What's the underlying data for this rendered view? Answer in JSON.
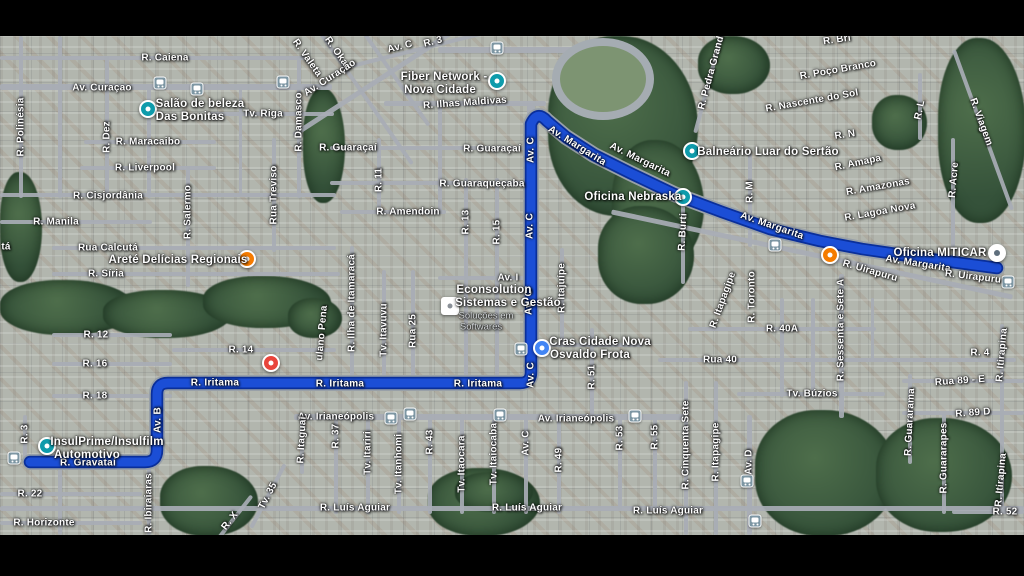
{
  "app": {
    "title": "Satellite map with driving route"
  },
  "colors": {
    "route": "#1b4ed6",
    "route_border": "#0a2f9a",
    "route_road_under": "#98a0a8",
    "label": "#ffffff",
    "sub_label": "#d8dbde",
    "poi_teal": "#0e9bab",
    "poi_orange": "#f57c00",
    "poi_red": "#e8453c",
    "poi_blue": "#4285f4",
    "poi_gray_inner": "#5f6f7d",
    "vegetation": "#3c5a40",
    "road": "#a8adb5",
    "letterbox": "#000000"
  },
  "route": {
    "path": "M 997 268 L 930 259 L 862 249 L 820 241 L 770 229 L 722 212 L 674 194 L 630 173 L 594 155 L 566 137 L 547 121 Q 537 110 531 124 L 531 372 Q 531 383 520 383 L 168 383 Q 157 383 157 394 L 157 450 Q 157 462 145 462 L 30 462"
  },
  "labels": [
    {
      "t": "R. Caiena",
      "x": 165,
      "y": 58,
      "r": 0,
      "c": "st"
    },
    {
      "t": "Av. Curaçao",
      "x": 102,
      "y": 88,
      "r": 0,
      "c": "st"
    },
    {
      "t": "Tv. Riga",
      "x": 263,
      "y": 114,
      "r": 0,
      "c": "st"
    },
    {
      "t": "R. Maracaibo",
      "x": 148,
      "y": 142,
      "r": 0,
      "c": "st"
    },
    {
      "t": "R. Liverpool",
      "x": 145,
      "y": 168,
      "r": 0,
      "c": "st"
    },
    {
      "t": "R. Cisjordânia",
      "x": 108,
      "y": 196,
      "r": 0,
      "c": "st"
    },
    {
      "t": "R. Manila",
      "x": 56,
      "y": 222,
      "r": 0,
      "c": "st"
    },
    {
      "t": "Rua Calcutá",
      "x": 108,
      "y": 248,
      "r": 0,
      "c": "st"
    },
    {
      "t": "tá",
      "x": 6,
      "y": 247,
      "r": 0,
      "c": "st"
    },
    {
      "t": "R. Síria",
      "x": 106,
      "y": 274,
      "r": 0,
      "c": "st"
    },
    {
      "t": "R. 12",
      "x": 96,
      "y": 335,
      "r": 0,
      "c": "st"
    },
    {
      "t": "R. 14",
      "x": 241,
      "y": 350,
      "r": 0,
      "c": "st"
    },
    {
      "t": "R. 16",
      "x": 95,
      "y": 364,
      "r": 0,
      "c": "st"
    },
    {
      "t": "R. 18",
      "x": 95,
      "y": 396,
      "r": 0,
      "c": "st"
    },
    {
      "t": "R. 22",
      "x": 30,
      "y": 494,
      "r": 0,
      "c": "st"
    },
    {
      "t": "R. Horizonte",
      "x": 44,
      "y": 523,
      "r": 0,
      "c": "st"
    },
    {
      "t": "R. Gravataí",
      "x": 88,
      "y": 463,
      "r": 0,
      "c": "rt"
    },
    {
      "t": "R. Iritama",
      "x": 215,
      "y": 383,
      "r": 0,
      "c": "rt"
    },
    {
      "t": "R. Iritama",
      "x": 340,
      "y": 384,
      "r": 0,
      "c": "rt"
    },
    {
      "t": "R. Iritama",
      "x": 478,
      "y": 384,
      "r": 0,
      "c": "rt"
    },
    {
      "t": "Av. B",
      "x": 158,
      "y": 420,
      "r": -90,
      "c": "rt"
    },
    {
      "t": "Av. C",
      "x": 531,
      "y": 150,
      "r": -90,
      "c": "rt"
    },
    {
      "t": "Av. C",
      "x": 530,
      "y": 226,
      "r": -90,
      "c": "rt"
    },
    {
      "t": "Av. C",
      "x": 529,
      "y": 302,
      "r": -90,
      "c": "rt"
    },
    {
      "t": "Av. C",
      "x": 531,
      "y": 375,
      "r": -90,
      "c": "rt"
    },
    {
      "t": "Av. Margarita",
      "x": 577,
      "y": 146,
      "r": 32,
      "c": "rt"
    },
    {
      "t": "Av. Margarita",
      "x": 640,
      "y": 160,
      "r": 26,
      "c": "rt"
    },
    {
      "t": "Av. Margarita",
      "x": 772,
      "y": 226,
      "r": 19,
      "c": "rt"
    },
    {
      "t": "Av. Margarita",
      "x": 918,
      "y": 264,
      "r": 9,
      "c": "rt"
    },
    {
      "t": "R. Uirapuru",
      "x": 870,
      "y": 271,
      "r": 16,
      "c": "st"
    },
    {
      "t": "R. Uirapuru",
      "x": 973,
      "y": 277,
      "r": 7,
      "c": "st"
    },
    {
      "t": "R. Ilhas Maldivas",
      "x": 465,
      "y": 103,
      "r": -4,
      "c": "st"
    },
    {
      "t": "R. Guaraçaí",
      "x": 348,
      "y": 148,
      "r": 0,
      "c": "st"
    },
    {
      "t": "R. Guaraçaí",
      "x": 492,
      "y": 149,
      "r": 0,
      "c": "st"
    },
    {
      "t": "R. Guaraqueçaba",
      "x": 482,
      "y": 184,
      "r": 0,
      "c": "st"
    },
    {
      "t": "R. Amendoin",
      "x": 408,
      "y": 212,
      "r": 0,
      "c": "st"
    },
    {
      "t": "Av. I",
      "x": 508,
      "y": 278,
      "r": 0,
      "c": "st"
    },
    {
      "t": "Av. Irianeópolis",
      "x": 336,
      "y": 417,
      "r": 0,
      "c": "st"
    },
    {
      "t": "Av. Irianeópolis",
      "x": 576,
      "y": 419,
      "r": 0,
      "c": "st"
    },
    {
      "t": "R. Luís Aguiar",
      "x": 355,
      "y": 508,
      "r": 0,
      "c": "st"
    },
    {
      "t": "R. Luís Aguiar",
      "x": 527,
      "y": 508,
      "r": 0,
      "c": "st"
    },
    {
      "t": "R. Luís Aguiar",
      "x": 668,
      "y": 511,
      "r": 0,
      "c": "st"
    },
    {
      "t": "R. Poço Branco",
      "x": 838,
      "y": 70,
      "r": -10,
      "c": "st"
    },
    {
      "t": "R. Nascente do Sol",
      "x": 812,
      "y": 101,
      "r": -10,
      "c": "st"
    },
    {
      "t": "R. N",
      "x": 845,
      "y": 135,
      "r": -8,
      "c": "st"
    },
    {
      "t": "R. Amapa",
      "x": 858,
      "y": 163,
      "r": -12,
      "c": "st"
    },
    {
      "t": "R. Amazonas",
      "x": 878,
      "y": 187,
      "r": -10,
      "c": "st"
    },
    {
      "t": "R. Lagoa Nova",
      "x": 880,
      "y": 212,
      "r": -10,
      "c": "st"
    },
    {
      "t": "Rua 40",
      "x": 720,
      "y": 360,
      "r": 0,
      "c": "st"
    },
    {
      "t": "R. 40A",
      "x": 782,
      "y": 329,
      "r": 0,
      "c": "st"
    },
    {
      "t": "Tv. Búzios",
      "x": 812,
      "y": 394,
      "r": 0,
      "c": "st"
    },
    {
      "t": "Rua 89 - E",
      "x": 960,
      "y": 381,
      "r": -4,
      "c": "st"
    },
    {
      "t": "R. 89 D",
      "x": 973,
      "y": 413,
      "r": -4,
      "c": "st"
    },
    {
      "t": "R. 52",
      "x": 1005,
      "y": 512,
      "r": 0,
      "c": "st"
    },
    {
      "t": "R. 4",
      "x": 980,
      "y": 353,
      "r": 0,
      "c": "st"
    },
    {
      "t": "R. Bri",
      "x": 837,
      "y": 40,
      "r": -8,
      "c": "st"
    },
    {
      "t": "R. Valeta",
      "x": 307,
      "y": 58,
      "r": 55,
      "c": "st"
    },
    {
      "t": "R. Okatí",
      "x": 338,
      "y": 54,
      "r": 55,
      "c": "st"
    },
    {
      "t": "Av. Curaçao",
      "x": 330,
      "y": 78,
      "r": -33,
      "c": "st"
    },
    {
      "t": "Av. C",
      "x": 400,
      "y": 47,
      "r": -14,
      "c": "st"
    },
    {
      "t": "R. 3",
      "x": 433,
      "y": 42,
      "r": -14,
      "c": "st"
    },
    {
      "t": "R. Pedra Grande",
      "x": 712,
      "y": 70,
      "r": -75,
      "c": "st"
    },
    {
      "t": "R. Viagem",
      "x": 981,
      "y": 122,
      "r": 70,
      "c": "st"
    },
    {
      "t": "R. Polinésia",
      "x": 21,
      "y": 127,
      "r": -90,
      "c": "st"
    },
    {
      "t": "R. Dez",
      "x": 107,
      "y": 137,
      "r": -90,
      "c": "st"
    },
    {
      "t": "R. Damasco",
      "x": 299,
      "y": 122,
      "r": -90,
      "c": "st"
    },
    {
      "t": "R. Salermo",
      "x": 188,
      "y": 212,
      "r": -90,
      "c": "st"
    },
    {
      "t": "Rua Treviso",
      "x": 274,
      "y": 195,
      "r": -90,
      "c": "st"
    },
    {
      "t": "R. 11",
      "x": 379,
      "y": 180,
      "r": -90,
      "c": "st"
    },
    {
      "t": "R. 13",
      "x": 466,
      "y": 222,
      "r": -90,
      "c": "st"
    },
    {
      "t": "R. 15",
      "x": 497,
      "y": 232,
      "r": -90,
      "c": "st"
    },
    {
      "t": "R. Ilha de Itamaracá",
      "x": 352,
      "y": 303,
      "r": -90,
      "c": "st"
    },
    {
      "t": "Tv. Itavuvu",
      "x": 384,
      "y": 330,
      "r": -90,
      "c": "st"
    },
    {
      "t": "Rua 25",
      "x": 413,
      "y": 331,
      "r": -90,
      "c": "st"
    },
    {
      "t": "ulano Pena",
      "x": 322,
      "y": 333,
      "r": -85,
      "c": "st"
    },
    {
      "t": "R. Burti",
      "x": 683,
      "y": 232,
      "r": -87,
      "c": "st"
    },
    {
      "t": "R. M",
      "x": 750,
      "y": 192,
      "r": -90,
      "c": "st"
    },
    {
      "t": "R. Itajuípe",
      "x": 562,
      "y": 288,
      "r": -90,
      "c": "st"
    },
    {
      "t": "R. Itapagipe",
      "x": 723,
      "y": 300,
      "r": -70,
      "c": "st"
    },
    {
      "t": "R. Toronto",
      "x": 752,
      "y": 297,
      "r": -90,
      "c": "st"
    },
    {
      "t": "R. Sessenta e Sete A",
      "x": 841,
      "y": 330,
      "r": -90,
      "c": "st"
    },
    {
      "t": "R. Acre",
      "x": 954,
      "y": 180,
      "r": -85,
      "c": "st"
    },
    {
      "t": "R. L",
      "x": 920,
      "y": 110,
      "r": -78,
      "c": "st"
    },
    {
      "t": "R. 37",
      "x": 336,
      "y": 436,
      "r": -90,
      "c": "st"
    },
    {
      "t": "Tv. Itariri",
      "x": 368,
      "y": 453,
      "r": -90,
      "c": "st"
    },
    {
      "t": "Tv. Itanhomi",
      "x": 399,
      "y": 464,
      "r": -90,
      "c": "st"
    },
    {
      "t": "R. 43",
      "x": 430,
      "y": 442,
      "r": -90,
      "c": "st"
    },
    {
      "t": "Tv. Itaocara",
      "x": 462,
      "y": 464,
      "r": -90,
      "c": "st"
    },
    {
      "t": "Tv. Itaiocaba",
      "x": 494,
      "y": 454,
      "r": -90,
      "c": "st"
    },
    {
      "t": "Av. C",
      "x": 526,
      "y": 443,
      "r": -90,
      "c": "st"
    },
    {
      "t": "R. 49",
      "x": 559,
      "y": 460,
      "r": -90,
      "c": "st"
    },
    {
      "t": "R. 51",
      "x": 592,
      "y": 377,
      "r": -90,
      "c": "st"
    },
    {
      "t": "R. 53",
      "x": 620,
      "y": 438,
      "r": -90,
      "c": "st"
    },
    {
      "t": "R. 55",
      "x": 655,
      "y": 437,
      "r": -90,
      "c": "st"
    },
    {
      "t": "R. Cinquenta Sete",
      "x": 686,
      "y": 445,
      "r": -90,
      "c": "st"
    },
    {
      "t": "R. Itapagipe",
      "x": 716,
      "y": 452,
      "r": -90,
      "c": "st"
    },
    {
      "t": "Av. D",
      "x": 749,
      "y": 462,
      "r": -90,
      "c": "st"
    },
    {
      "t": "R. Guararama",
      "x": 910,
      "y": 422,
      "r": -87,
      "c": "st"
    },
    {
      "t": "R. Guararapes",
      "x": 944,
      "y": 458,
      "r": -90,
      "c": "st"
    },
    {
      "t": "R. Itirapina",
      "x": 1002,
      "y": 355,
      "r": -85,
      "c": "st"
    },
    {
      "t": "R. Itirapina",
      "x": 1001,
      "y": 480,
      "r": -85,
      "c": "st"
    },
    {
      "t": "R. Itaguaí",
      "x": 302,
      "y": 440,
      "r": -87,
      "c": "st"
    },
    {
      "t": "R. Ibiraiaras",
      "x": 149,
      "y": 503,
      "r": -90,
      "c": "st"
    },
    {
      "t": "Tv. 35",
      "x": 268,
      "y": 496,
      "r": -62,
      "c": "st"
    },
    {
      "t": "R. X",
      "x": 230,
      "y": 521,
      "r": -52,
      "c": "st"
    },
    {
      "t": "R. 3",
      "x": 25,
      "y": 434,
      "r": -90,
      "c": "st"
    },
    {
      "t": "Salão de beleza",
      "x": 200,
      "y": 104,
      "r": 0,
      "c": "poi"
    },
    {
      "t": "Das Bonitas",
      "x": 190,
      "y": 117,
      "r": 0,
      "c": "poi"
    },
    {
      "t": "Fiber Network -",
      "x": 444,
      "y": 77,
      "r": 0,
      "c": "poi"
    },
    {
      "t": "Nova Cidade",
      "x": 440,
      "y": 90,
      "r": 0,
      "c": "poi"
    },
    {
      "t": "Areté Delícias Regionais",
      "x": 178,
      "y": 260,
      "r": 0,
      "c": "poi"
    },
    {
      "t": "InsulPrime/Insulfilm",
      "x": 107,
      "y": 442,
      "r": 0,
      "c": "poi"
    },
    {
      "t": "Automotivo",
      "x": 87,
      "y": 455,
      "r": 0,
      "c": "poi"
    },
    {
      "t": "Econsolution",
      "x": 494,
      "y": 290,
      "r": 0,
      "c": "poi"
    },
    {
      "t": "Sistemas e Gestão",
      "x": 508,
      "y": 303,
      "r": 0,
      "c": "poi"
    },
    {
      "t": "Soluções em",
      "x": 486,
      "y": 316,
      "r": 0,
      "c": "sub"
    },
    {
      "t": "Softwares",
      "x": 481,
      "y": 327,
      "r": 0,
      "c": "sub"
    },
    {
      "t": "Cras Cidade Nova",
      "x": 600,
      "y": 342,
      "r": 0,
      "c": "poi"
    },
    {
      "t": "Osvaldo Frota",
      "x": 590,
      "y": 355,
      "r": 0,
      "c": "poi"
    },
    {
      "t": "Oficina Nebraska",
      "x": 633,
      "y": 197,
      "r": 0,
      "c": "poi"
    },
    {
      "t": "Balneário Luar do Sertão",
      "x": 768,
      "y": 152,
      "r": 0,
      "c": "poi"
    },
    {
      "t": "Oficina MITICAR",
      "x": 940,
      "y": 253,
      "r": 0,
      "c": "poi"
    }
  ],
  "pois": [
    {
      "x": 148,
      "y": 109,
      "kind": "teal",
      "name": "salao-de-beleza-poi"
    },
    {
      "x": 497,
      "y": 81,
      "kind": "teal",
      "name": "fiber-network-poi"
    },
    {
      "x": 247,
      "y": 259,
      "kind": "orange",
      "name": "arete-delicias-poi"
    },
    {
      "x": 830,
      "y": 255,
      "kind": "orange",
      "name": "food-poi"
    },
    {
      "x": 271,
      "y": 363,
      "kind": "red",
      "name": "health-poi"
    },
    {
      "x": 47,
      "y": 446,
      "kind": "teal",
      "name": "insulprime-poi"
    },
    {
      "x": 450,
      "y": 306,
      "kind": "square",
      "name": "econsolution-poi"
    },
    {
      "x": 542,
      "y": 348,
      "kind": "blue",
      "name": "cras-cidade-nova-poi"
    },
    {
      "x": 683,
      "y": 197,
      "kind": "teal",
      "name": "oficina-nebraska-poi"
    },
    {
      "x": 692,
      "y": 151,
      "kind": "teal",
      "name": "balneario-poi"
    },
    {
      "x": 997,
      "y": 253,
      "kind": "gray",
      "name": "oficina-miticar-poi"
    }
  ],
  "transit_stops": [
    [
      160,
      83
    ],
    [
      197,
      89
    ],
    [
      283,
      82
    ],
    [
      497,
      48
    ],
    [
      521,
      349
    ],
    [
      391,
      418
    ],
    [
      410,
      414
    ],
    [
      500,
      415
    ],
    [
      635,
      416
    ],
    [
      775,
      245
    ],
    [
      1008,
      282
    ],
    [
      14,
      458
    ],
    [
      747,
      481
    ],
    [
      755,
      521
    ]
  ]
}
